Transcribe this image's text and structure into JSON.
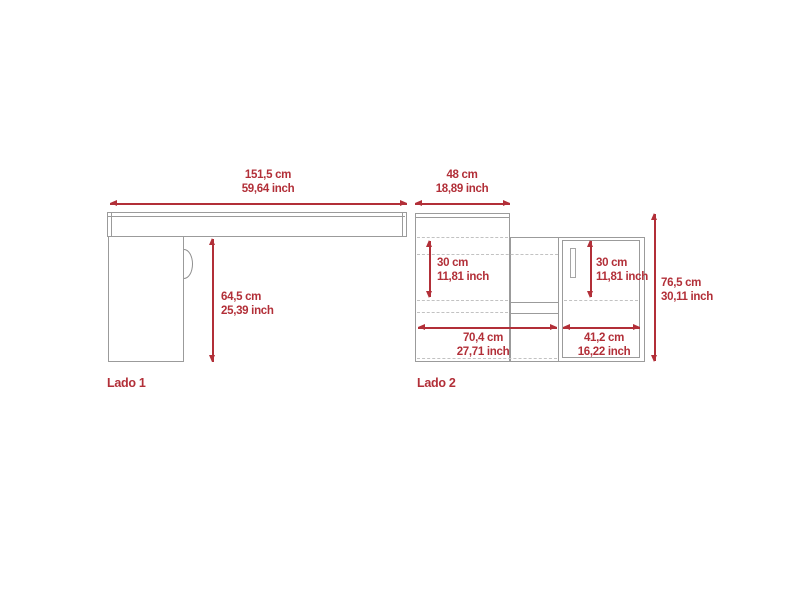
{
  "drawing": {
    "side1": {
      "label": "Lado 1",
      "top_width": {
        "cm": "151,5 cm",
        "inch": "59,64 inch"
      },
      "leg_height": {
        "cm": "64,5 cm",
        "inch": "25,39 inch"
      }
    },
    "side2": {
      "label": "Lado 2",
      "top_depth": {
        "cm": "48 cm",
        "inch": "18,89 inch"
      },
      "left_shelf_clearance": {
        "cm": "30 cm",
        "inch": "11,81 inch"
      },
      "door_shelf_clearance": {
        "cm": "30 cm",
        "inch": "11,81 inch"
      },
      "left_section_width": {
        "cm": "70,4 cm",
        "inch": "27,71 inch"
      },
      "door_section_width": {
        "cm": "41,2 cm",
        "inch": "16,22 inch"
      },
      "overall_height": {
        "cm": "76,5 cm",
        "inch": "30,11 inch"
      }
    },
    "colors": {
      "dimension_red": "#b22f38",
      "outline_gray": "#9b9b9b",
      "dashed_gray": "#c2c2c2"
    }
  }
}
